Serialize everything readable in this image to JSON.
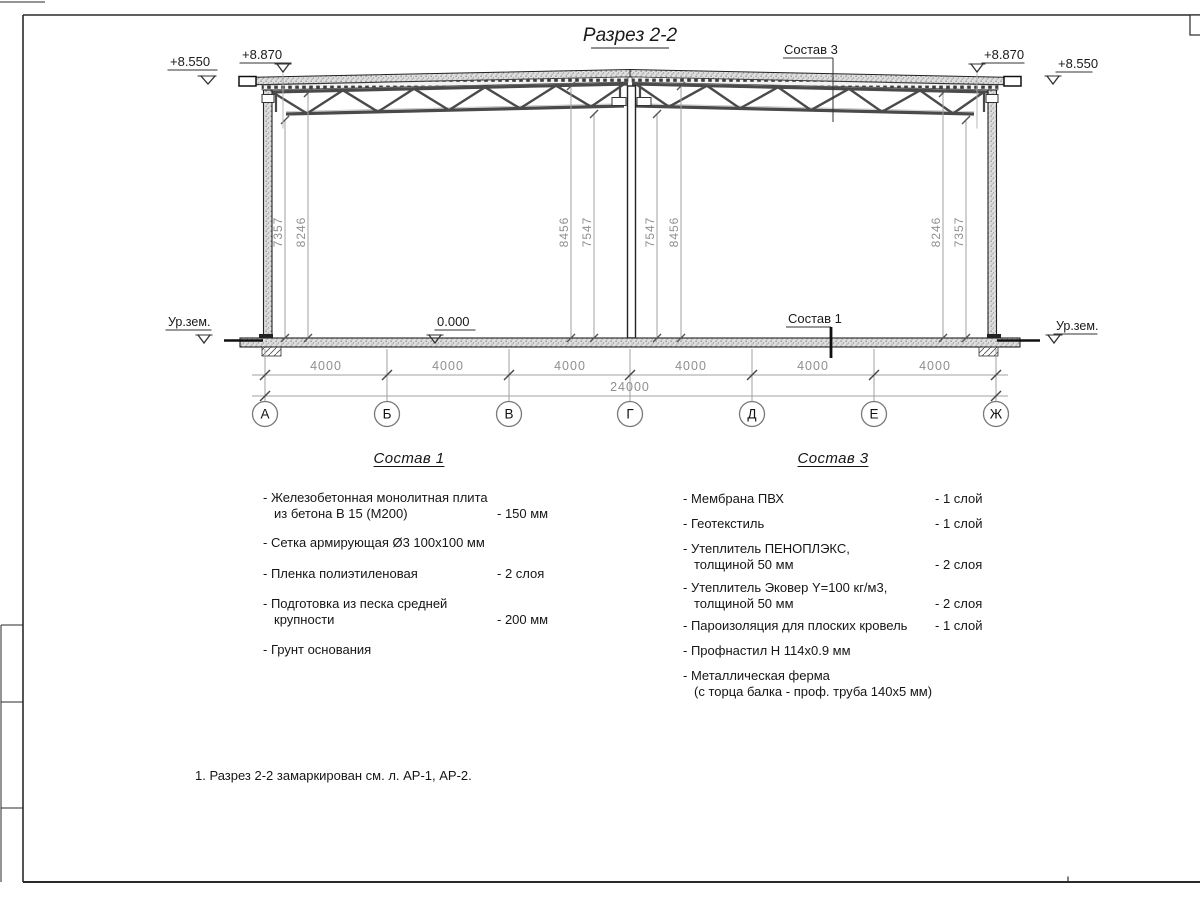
{
  "sheet": {
    "title": "Разрез 2-2"
  },
  "drawing": {
    "elev_left_outer": "+8.550",
    "elev_left_inner": "+8.870",
    "elev_right_inner": "+8.870",
    "elev_right_outer": "+8.550",
    "ground_left": "Ур.зем.",
    "ground_right": "Ур.зем.",
    "zero": "0.000",
    "leader_roof": "Состав 3",
    "leader_floor": "Состав 1",
    "vdims": [
      "7357",
      "8246",
      "8456",
      "7547",
      "7547",
      "8456",
      "8246",
      "7357"
    ],
    "hdims": [
      "4000",
      "4000",
      "4000",
      "4000",
      "4000",
      "4000"
    ],
    "total": "24000",
    "axes": [
      "А",
      "Б",
      "В",
      "Г",
      "Д",
      "Е",
      "Ж"
    ]
  },
  "sostav1": {
    "heading": "Состав 1",
    "items": [
      {
        "line1": "- Железобетонная  монолитная плита",
        "line2": "из бетона В 15 (М200)",
        "value": "- 150 мм"
      },
      {
        "line1": "- Сетка армирующая Ø3 100х100 мм",
        "line2": "",
        "value": ""
      },
      {
        "line1": "- Пленка полиэтиленовая",
        "line2": "",
        "value": "-  2 слоя"
      },
      {
        "line1": "- Подготовка из песка средней",
        "line2": "крупности",
        "value": "- 200 мм"
      },
      {
        "line1": "- Грунт основания",
        "line2": "",
        "value": ""
      }
    ]
  },
  "sostav3": {
    "heading": "Состав 3",
    "items": [
      {
        "line1": "- Мембрана ПВХ",
        "line2": "",
        "value": "- 1 слой"
      },
      {
        "line1": "- Геотекстиль",
        "line2": "",
        "value": "- 1 слой"
      },
      {
        "line1": "- Утеплитель ПЕНОПЛЭКС,",
        "line2": "толщиной 50 мм",
        "value": "- 2 слоя"
      },
      {
        "line1": "- Утеплитель Эковер Y=100 кг/м3,",
        "line2": "толщиной 50 мм",
        "value": "- 2 слоя"
      },
      {
        "line1": "- Пароизоляция для плоских кровель",
        "line2": "",
        "value": "- 1 слой"
      },
      {
        "line1": "- Профнастил Н 114х0.9 мм",
        "line2": "",
        "value": ""
      },
      {
        "line1": "- Металлическая ферма",
        "line2": "(с торца балка - проф. труба 140х5 мм)",
        "value": ""
      }
    ]
  },
  "note": "1. Разрез 2-2 замаркирован см. л. АР-1, АР-2.",
  "colors": {
    "line": "#2a2a2a",
    "dim": "#8f8f8f",
    "structure": "#4a4a4a",
    "paper": "#ffffff"
  }
}
